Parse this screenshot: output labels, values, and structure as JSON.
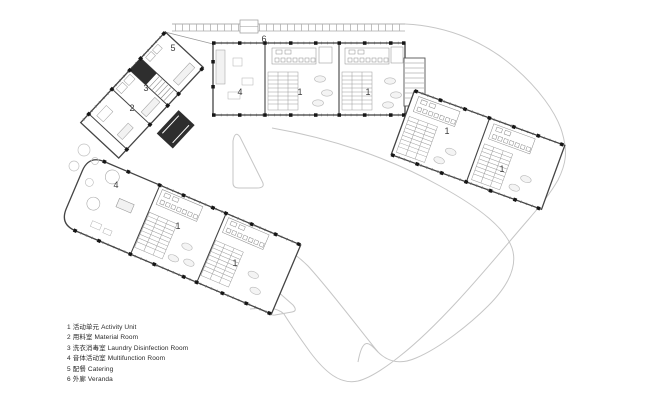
{
  "figure": {
    "type": "architectural-floor-plan"
  },
  "colors": {
    "wall": "#444444",
    "column": "#161616",
    "furniture": "#9a9a9a",
    "site_path": "#c6c6c6",
    "background": "#ffffff",
    "dark_core": "#2e2e2e"
  },
  "plan": {
    "room_labels": [
      {
        "text": "5",
        "x": 173,
        "y": 51
      },
      {
        "text": "3",
        "x": 146,
        "y": 91
      },
      {
        "text": "2",
        "x": 132,
        "y": 111
      },
      {
        "text": "4",
        "x": 240,
        "y": 95
      },
      {
        "text": "1",
        "x": 300,
        "y": 95
      },
      {
        "text": "1",
        "x": 368,
        "y": 95
      },
      {
        "text": "6",
        "x": 264,
        "y": 42
      },
      {
        "text": "1",
        "x": 447,
        "y": 134
      },
      {
        "text": "1",
        "x": 502,
        "y": 172
      },
      {
        "text": "4",
        "x": 116,
        "y": 188
      },
      {
        "text": "1",
        "x": 178,
        "y": 229
      },
      {
        "text": "1",
        "x": 235,
        "y": 266
      }
    ]
  },
  "legend": {
    "items": [
      {
        "num": "1",
        "zh": "活动单元",
        "en": "Activity Unit"
      },
      {
        "num": "2",
        "zh": "用料室",
        "en": "Material Room"
      },
      {
        "num": "3",
        "zh": "洗衣消毒室",
        "en": "Laundry Disinfection Room"
      },
      {
        "num": "4",
        "zh": "音体活动室",
        "en": "Multifunction Room"
      },
      {
        "num": "5",
        "zh": "配餐",
        "en": "Catering"
      },
      {
        "num": "6",
        "zh": "外廊",
        "en": "Veranda"
      }
    ]
  }
}
